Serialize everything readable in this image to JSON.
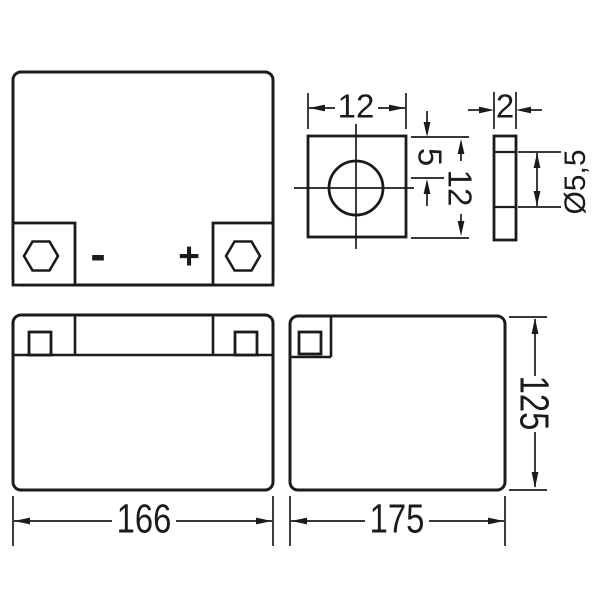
{
  "page": {
    "background": "#ffffff",
    "ink": "#1b1b1b"
  },
  "views": {
    "top_view": {
      "minus_label": "-",
      "plus_label": "+"
    },
    "terminal_front_detail": {
      "width": "12",
      "hole_offset": "5",
      "height": "12"
    },
    "terminal_side_detail": {
      "thickness": "2",
      "hole_diameter": "Ø5,5"
    },
    "front_view": {
      "width": "166"
    },
    "side_view": {
      "depth": "175",
      "height": "125"
    }
  }
}
